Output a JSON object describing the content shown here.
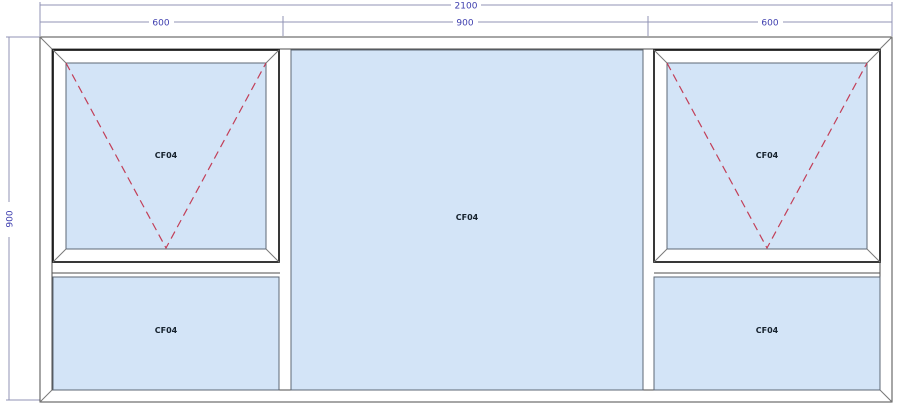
{
  "drawing": {
    "type": "window-elevation-drawing",
    "colors": {
      "background": "#ffffff",
      "glass_fill": "#d3e4f7",
      "frame_line": "#4d4d4d",
      "sash_line": "#161616",
      "dimension_line": "#9193b6",
      "dimension_text": "#3d3dae",
      "opening_dash": "#c23f58",
      "label_text": "#16222e"
    },
    "dimensions": {
      "overall_width": "2100",
      "overall_height": "900",
      "segments": [
        "600",
        "900",
        "600"
      ]
    },
    "panels": {
      "left_top": {
        "label": "CF04",
        "has_opening_symbol": true
      },
      "left_bottom": {
        "label": "CF04",
        "has_opening_symbol": false
      },
      "middle": {
        "label": "CF04",
        "has_opening_symbol": false
      },
      "right_top": {
        "label": "CF04",
        "has_opening_symbol": true
      },
      "right_bottom": {
        "label": "CF04",
        "has_opening_symbol": false
      }
    }
  }
}
